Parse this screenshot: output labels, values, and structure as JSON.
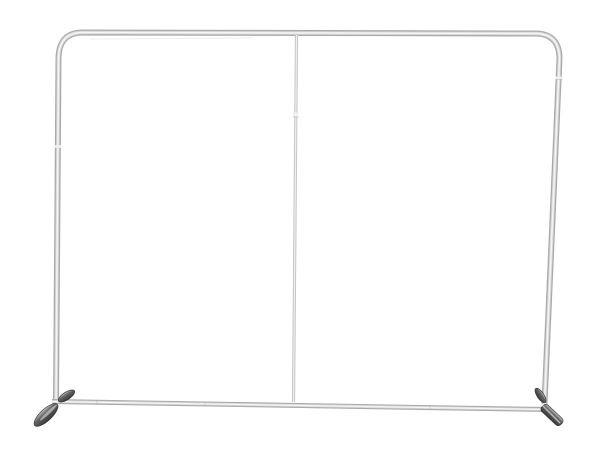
{
  "scene": {
    "description": "Empty silver aluminum tube backdrop frame (tension fabric display stand hardware) with rounded top corners, a thin vertical center support pole, a lower crossbar, and two dark angled stabilizer feet, photographed on a plain white background. No text or labels visible.",
    "background_color": "#ffffff"
  },
  "frame": {
    "tube_edge_color": "#ababab",
    "tube_mid_color": "#d7d7d7",
    "tube_core_color": "#f6f6f6",
    "center_pole_color": "#c6c6c6",
    "center_pole_core_color": "#efefef",
    "joint_color": "#f2f2f2",
    "joint_seam_color": "#9b9b9b",
    "reflection_color": "#dcdcdc"
  },
  "feet": {
    "top_highlight_color": "#c7c7c7",
    "body_color": "#686868",
    "shadow_color": "#383838",
    "outline_color": "#303030",
    "edge_highlight_color": "#d0d0d0"
  }
}
